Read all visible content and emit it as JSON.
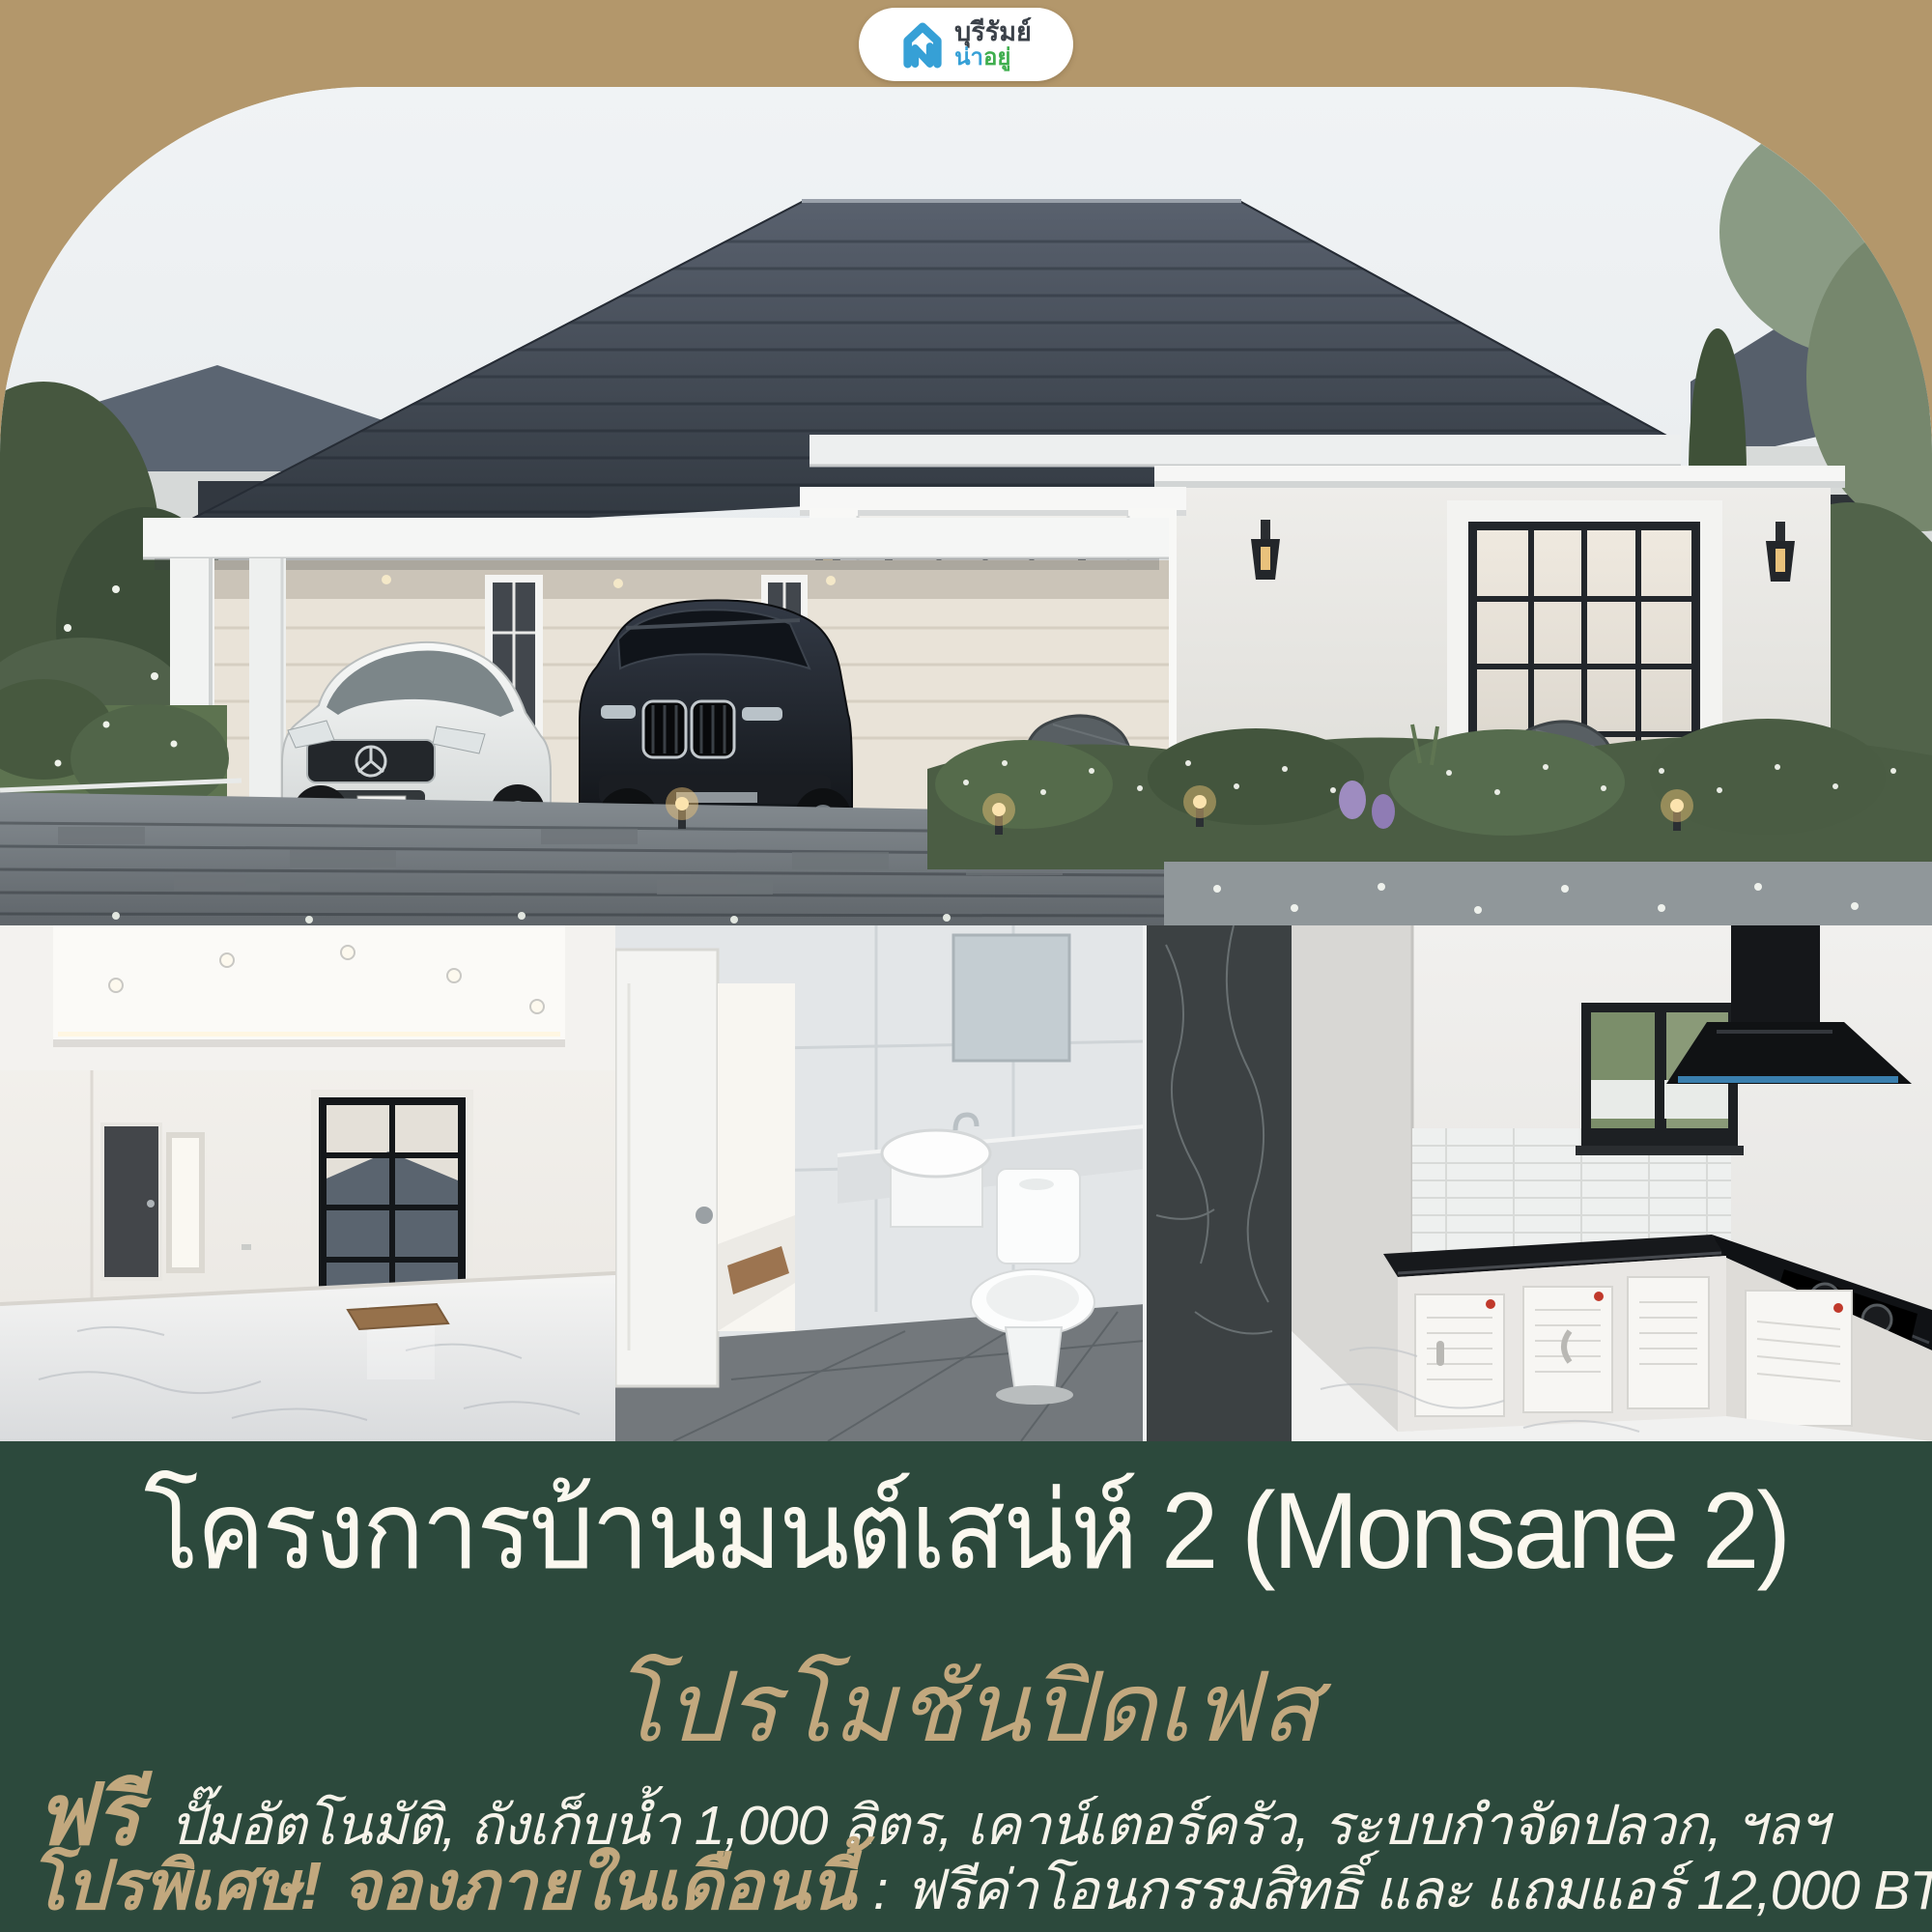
{
  "brand": {
    "logo_line1": "บุรีรัมย์",
    "logo_line2_part1": "น่า",
    "logo_line2_part2": "อยู่"
  },
  "promo": {
    "title": "โครงการบ้านมนต์เสน่ห์ 2 (Monsane 2)",
    "subtitle": "โปรโมชันปิดเฟส",
    "free_label": "ฟรี",
    "free_items": "ปั๊มอัตโนมัติ, ถังเก็บน้ำ 1,000 ลิตร, เคาน์เตอร์ครัว, ระบบกำจัดปลวก, ฯลฯ",
    "special_label": "โปรพิเศษ! จองภายในเดือนนี้",
    "special_separator": ":",
    "special_detail": "ฟรีค่าโอนกรรมสิทธิ์ และ แถมแอร์ 12,000 BTU 1 เครื่อง"
  },
  "colors": {
    "background_tan": "#b3976b",
    "panel_green": "#2c493c",
    "accent_gold": "#c2a87e",
    "text_cream": "#f6f3ea",
    "logo_blue": "#36a0d6",
    "logo_green": "#3fae4e",
    "logo_dark": "#3b4149",
    "roof_slate": "#39414d"
  }
}
